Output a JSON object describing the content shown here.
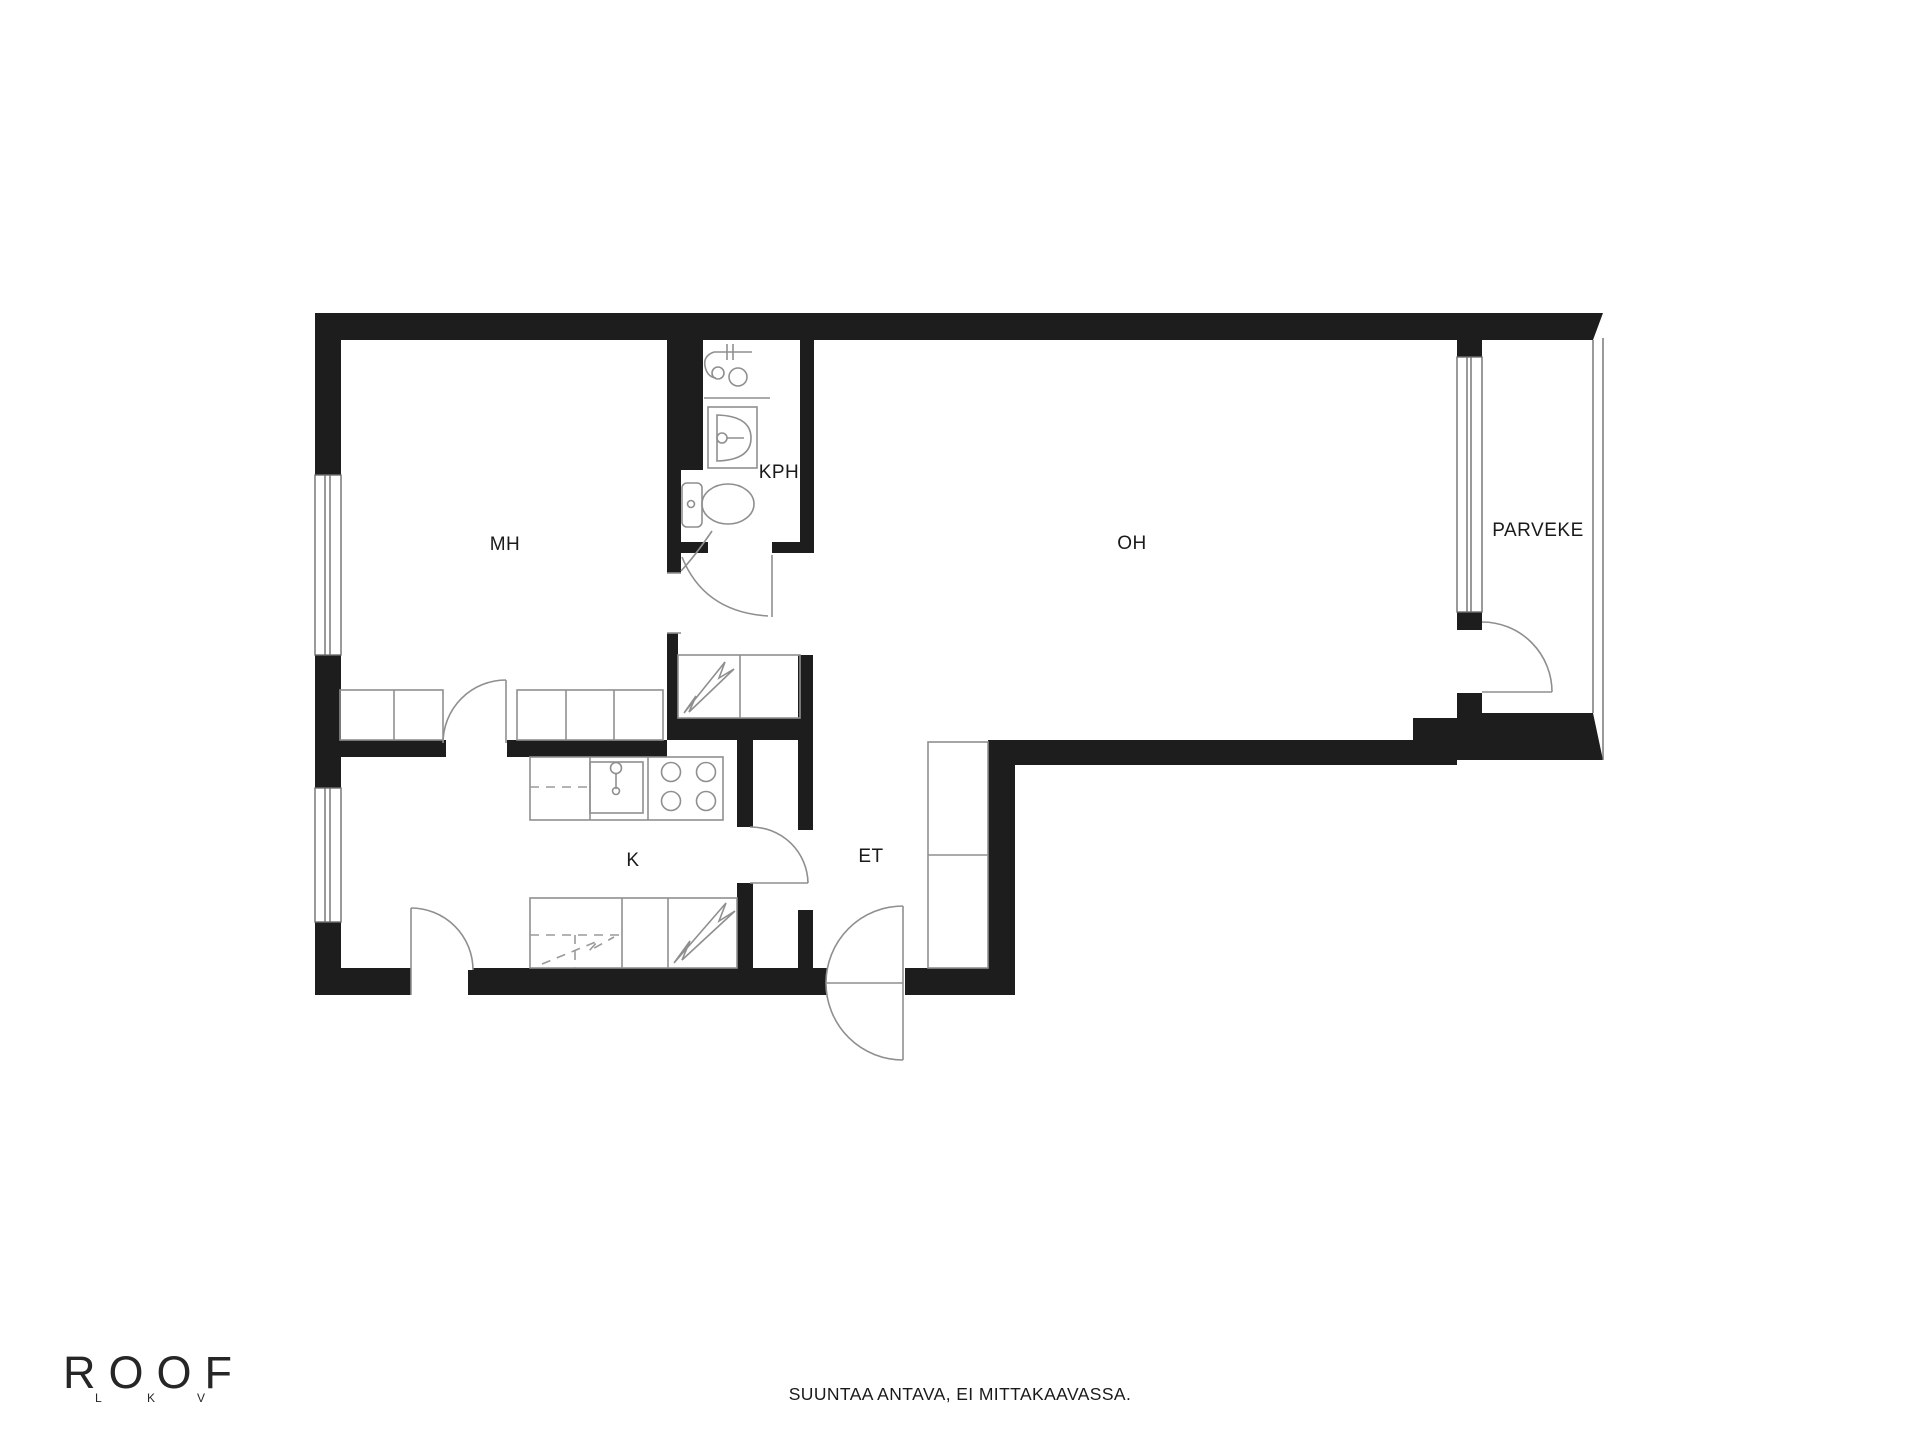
{
  "floor_plan": {
    "rooms": [
      {
        "id": "mh",
        "label": "MH"
      },
      {
        "id": "kph",
        "label": "KPH"
      },
      {
        "id": "oh",
        "label": "OH"
      },
      {
        "id": "parveke",
        "label": "PARVEKE"
      },
      {
        "id": "k",
        "label": "K"
      },
      {
        "id": "et",
        "label": "ET"
      }
    ],
    "colors": {
      "wall": "#1d1d1d",
      "furniture_line": "#8f8f8f",
      "window_line": "#6f6f6f",
      "label": "#1a1a1a",
      "background": "#ffffff"
    },
    "icons": [
      "window-icon",
      "door-swing-icon",
      "toilet-icon",
      "washbasin-icon",
      "shower-mixer-icon",
      "kitchen-sink-icon",
      "stove-icon",
      "lightning-bolt-icon",
      "wardrobe-icon",
      "closet-icon",
      "balcony-railing-icon"
    ]
  },
  "branding": {
    "name": "ROOF",
    "sub_letters": [
      "L",
      "K",
      "V"
    ]
  },
  "footer": {
    "disclaimer": "SUUNTAA ANTAVA, EI MITTAKAAVASSA."
  }
}
